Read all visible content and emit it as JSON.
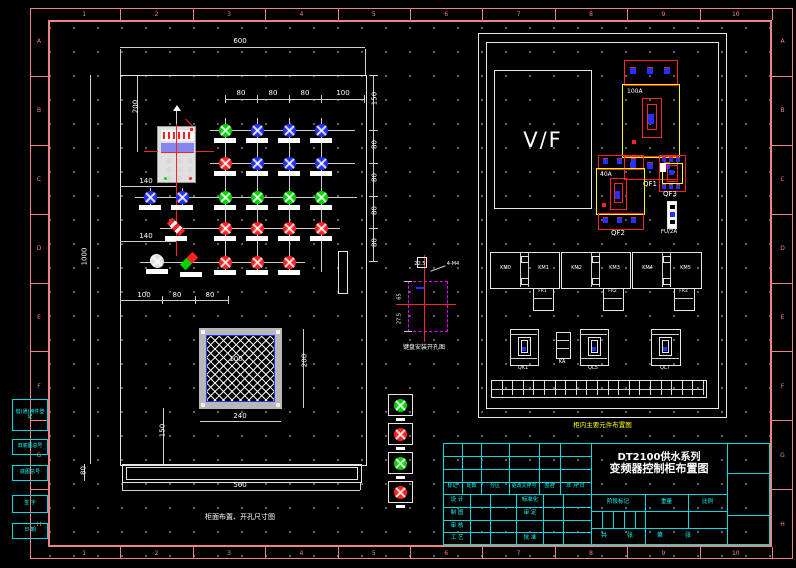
{
  "colors": {
    "frame": "#ee8585",
    "cyan": "#00ffff",
    "yellow": "#ffff00",
    "red": "#ff2222",
    "green": "#00d400",
    "blue": "#2430ff",
    "magenta": "#ff00ff",
    "purple": "#8585f0"
  },
  "zones": {
    "numbers": [
      "1",
      "2",
      "3",
      "4",
      "5",
      "6",
      "7",
      "8",
      "9",
      "10"
    ],
    "letters": [
      "A",
      "B",
      "C",
      "D",
      "E",
      "F",
      "G",
      "H"
    ]
  },
  "front_view": {
    "caption": "柜面布置、开孔尺寸图",
    "dims": {
      "width": "600",
      "height": "1000",
      "top_offset": "200",
      "col_140a": "140",
      "col_140b": "140",
      "cols": [
        "80",
        "80",
        "80",
        "100"
      ],
      "rows": [
        "150",
        "80",
        "80",
        "80",
        "80"
      ],
      "bottom": [
        "100",
        "80",
        "80"
      ],
      "mesh_size": "200",
      "mesh_width": "240",
      "mesh_center": "100",
      "mesh_below": "150",
      "base_width": "560",
      "base_height": "80"
    },
    "lights": [
      {
        "x": 225,
        "y": 130,
        "c": "green"
      },
      {
        "x": 257,
        "y": 130,
        "c": "blue"
      },
      {
        "x": 289,
        "y": 130,
        "c": "blue"
      },
      {
        "x": 321,
        "y": 130,
        "c": "blue"
      },
      {
        "x": 225,
        "y": 163,
        "c": "red"
      },
      {
        "x": 257,
        "y": 163,
        "c": "blue"
      },
      {
        "x": 289,
        "y": 163,
        "c": "blue"
      },
      {
        "x": 321,
        "y": 163,
        "c": "blue"
      },
      {
        "x": 150,
        "y": 197,
        "c": "blue"
      },
      {
        "x": 182,
        "y": 197,
        "c": "blue"
      },
      {
        "x": 225,
        "y": 197,
        "c": "green"
      },
      {
        "x": 257,
        "y": 197,
        "c": "green"
      },
      {
        "x": 289,
        "y": 197,
        "c": "green"
      },
      {
        "x": 321,
        "y": 197,
        "c": "green"
      },
      {
        "x": 225,
        "y": 228,
        "c": "red"
      },
      {
        "x": 257,
        "y": 228,
        "c": "red"
      },
      {
        "x": 289,
        "y": 228,
        "c": "red"
      },
      {
        "x": 321,
        "y": 228,
        "c": "red"
      },
      {
        "x": 157,
        "y": 261,
        "c": "white"
      },
      {
        "x": 225,
        "y": 262,
        "c": "red"
      },
      {
        "x": 257,
        "y": 262,
        "c": "red"
      },
      {
        "x": 289,
        "y": 262,
        "c": "red"
      }
    ]
  },
  "cutout_detail": {
    "caption": "键盘安装开孔图",
    "dim_a": "65",
    "dim_b": "27.5",
    "dim_c": "22.5",
    "leader": "4-M4"
  },
  "back_view": {
    "caption": "柜内主要元件布置图",
    "vf": "V/F",
    "qf1": {
      "name": "QF1",
      "rating": "100A"
    },
    "qf2": {
      "name": "QF2",
      "rating": "40A"
    },
    "qf3": {
      "name": "QF3"
    },
    "fuse": "FU/2A",
    "contactors": [
      "KM0",
      "KM1",
      "KM2",
      "KM3",
      "KM4",
      "KM5"
    ],
    "relays": [
      "FR1",
      "FR2",
      "FR3"
    ],
    "devices": [
      "QK1",
      "KA",
      "QL5",
      "QL7"
    ],
    "terminal_count": 20
  },
  "indicator_strip": [
    "green",
    "red",
    "green",
    "red"
  ],
  "title_block": {
    "title_line1": "DT2100供水系列",
    "title_line2": "变频器控制柜布置图",
    "rev_headers": [
      "标记",
      "处数",
      "分区",
      "更改文件号",
      "签名",
      "年 月 日"
    ],
    "sig_left": [
      "设 计",
      "制 图",
      "审 核",
      "工 艺"
    ],
    "sig_right": [
      "标准化",
      "审 定",
      "",
      "批 准"
    ],
    "stage": [
      "阶段标记",
      "重量",
      "比例"
    ],
    "sheets": [
      "共",
      "张",
      "第",
      "张"
    ]
  },
  "margin_blocks": [
    "借(通)用件登记",
    "旧底图总号",
    "底图总号",
    "签 字",
    "日 期"
  ]
}
